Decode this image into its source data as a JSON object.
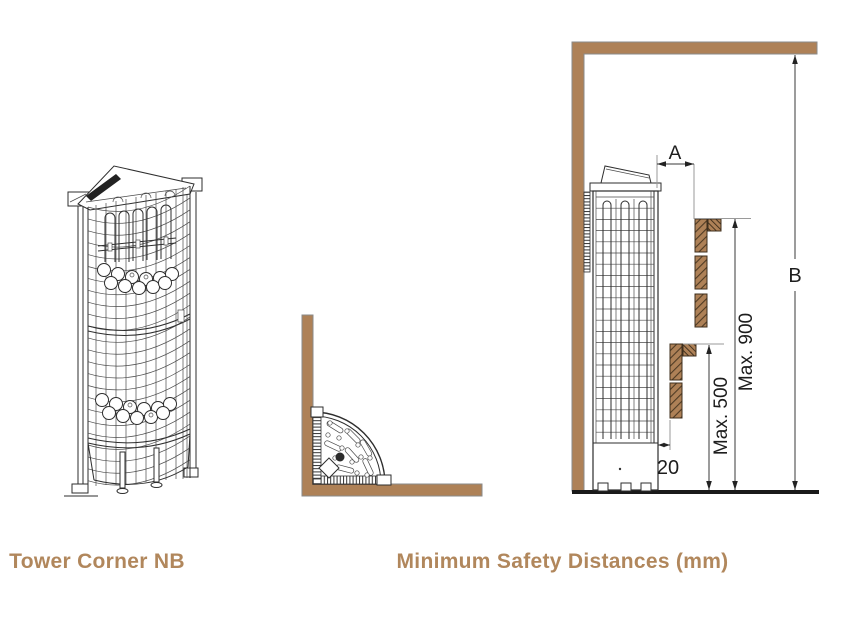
{
  "captions": {
    "product": "Tower Corner NB",
    "diagram": "Minimum Safety Distances (mm)"
  },
  "dimensions": {
    "a": "A",
    "b": "B",
    "max_900": "Max. 900",
    "max_500": "Max. 500",
    "gap": "20"
  },
  "colors": {
    "wood": "#ae8157",
    "caption_text": "#b1875c",
    "line_art": "#2e2e2e",
    "floor": "#1a1a1a"
  }
}
